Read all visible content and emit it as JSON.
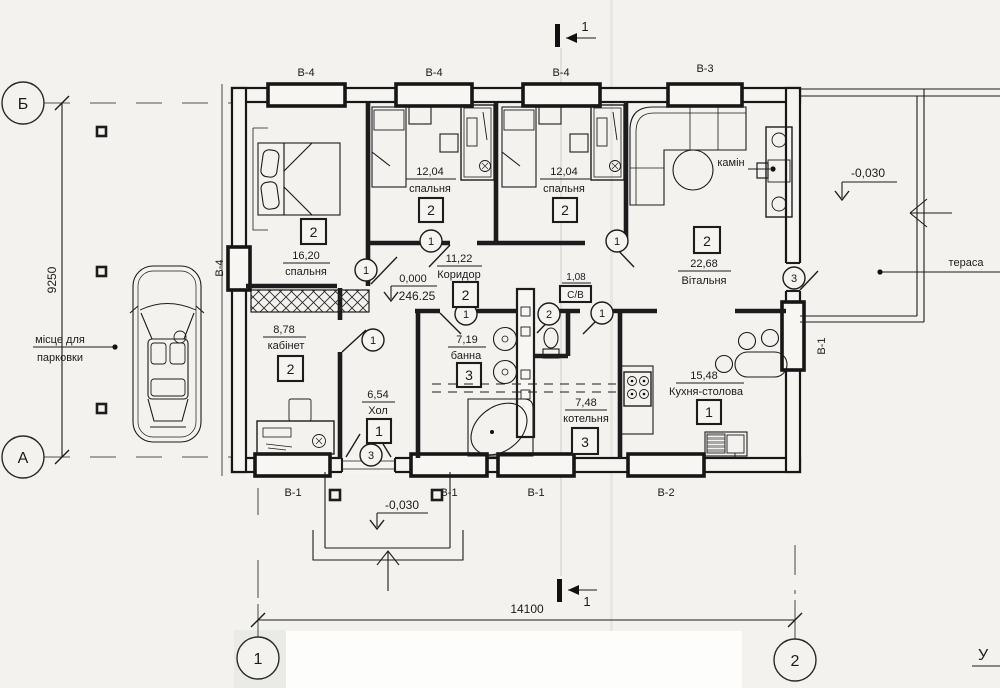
{
  "axes": {
    "top_left": "Б",
    "bottom_left": "А",
    "bottom_col_left": "1",
    "bottom_col_right": "2"
  },
  "dimensions": {
    "horizontal": "14100",
    "vertical": "9250"
  },
  "section_marks": {
    "top": "1",
    "bottom": "1"
  },
  "window_marks": {
    "top": [
      "В-4",
      "В-4",
      "В-4",
      "В-3"
    ],
    "bottom": [
      "В-1",
      "В-1",
      "В-1",
      "В-2"
    ],
    "left": "В-4",
    "right": "В-1"
  },
  "rooms": [
    {
      "num": "2",
      "area": "16,20",
      "name": "спальня"
    },
    {
      "num": "2",
      "area": "12,04",
      "name": "спальня"
    },
    {
      "num": "2",
      "area": "12,04",
      "name": "спальня"
    },
    {
      "num": "2",
      "area": "22,68",
      "name": "Вітальня"
    },
    {
      "num": "2",
      "area": "11,22",
      "name": "Коридор"
    },
    {
      "area": "1,08",
      "name": "С/В"
    },
    {
      "num": "3",
      "area": "7,19",
      "name": "банна"
    },
    {
      "num": "2",
      "area": "8,78",
      "name": "кабінет"
    },
    {
      "num": "1",
      "area": "6,54",
      "name": "Хол"
    },
    {
      "num": "3",
      "area": "7,48",
      "name": "котельня"
    },
    {
      "num": "1",
      "area": "15,48",
      "name": "Кухня-столова"
    }
  ],
  "door_marks": {
    "bedroom1": "1",
    "bedroom2": "1",
    "bedroom3": "1",
    "terrace_door": "3",
    "cabinet": "1",
    "bath": "1",
    "wc": "2",
    "kitchen": "1",
    "entrance": "3"
  },
  "elevations": {
    "floor_relative": "0,000",
    "floor_absolute": "246.25",
    "porch": "-0,030",
    "terrace": "-0,030"
  },
  "annotations": {
    "terrace": "тераса",
    "fireplace": "камін",
    "parking_line1": "місце для",
    "parking_line2": "парковки",
    "corner_mark": "У"
  }
}
